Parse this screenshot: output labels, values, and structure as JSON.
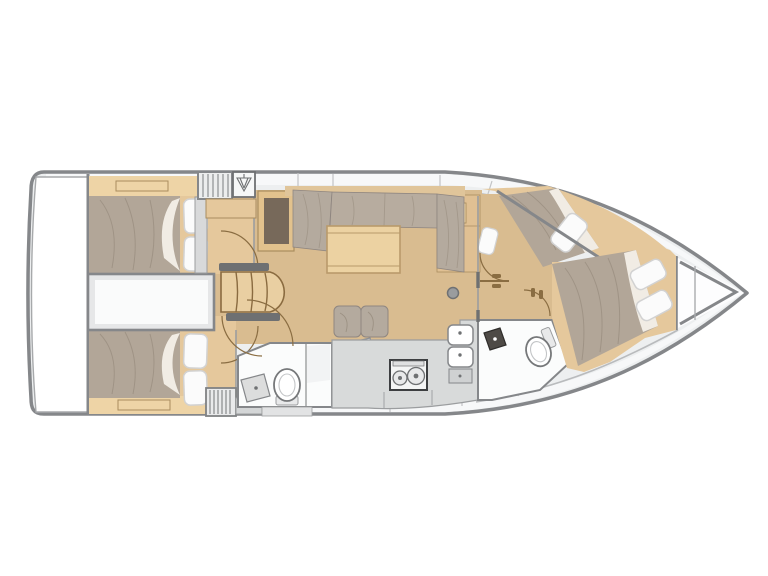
{
  "plan": {
    "type": "sailboat-interior-layout-top-view",
    "areas": [
      {
        "id": "transom-platform"
      },
      {
        "id": "aft-cabin-starboard"
      },
      {
        "id": "aft-cabin-port"
      },
      {
        "id": "engine-compartment"
      },
      {
        "id": "companionway-steps"
      },
      {
        "id": "hanging-locker"
      },
      {
        "id": "nav-cabinet"
      },
      {
        "id": "salon-settee"
      },
      {
        "id": "salon-table"
      },
      {
        "id": "salon-bench"
      },
      {
        "id": "chart-desk"
      },
      {
        "id": "aft-head"
      },
      {
        "id": "galley"
      },
      {
        "id": "forward-head"
      },
      {
        "id": "forward-cabin-starboard-berth"
      },
      {
        "id": "forward-cabin-main"
      },
      {
        "id": "anchor-locker"
      },
      {
        "id": "mast-post"
      }
    ]
  },
  "palette": {
    "background": "#ffffff",
    "hull_outline": "#85878a",
    "deck": "#edeff0",
    "deck_band": "#f7f8f9",
    "deck_seam": "#c2c4c6",
    "floor_wood": "#d9bc90",
    "cabin_wood": "#e5c89c",
    "wood_trim": "#eed4a6",
    "wood_edge": "#a98d5f",
    "duvet": "#b2a698",
    "duvet_crease": "#968a7c",
    "sheet": "#f1ece4",
    "pillow": "#fbfbfb",
    "pillow_edge": "#d2d2d2",
    "cushion": "#b4aa9e",
    "cushion_crease": "#9c9183",
    "counter": "#d8dada",
    "counter_edge": "#9b9d9f",
    "fixture_white": "#fbfcfc",
    "wall": "#85878a",
    "wall_light": "#9b9d9f",
    "door_arc": "#8a6d42",
    "dark_ledge": "#6e7072",
    "nav_inset": "#77695a",
    "dark_sink": "#4e4a46",
    "table_wood": "#ecd2a2",
    "table_edge": "#b99a6b",
    "steps_wood": "#e9cfa2",
    "steps_edge": "#8a6b40",
    "engine_fill": "#e6e7e8",
    "engine_inner": "#fafbfb",
    "stove_edge": "#3d3f41",
    "stripe": "#8e9092"
  }
}
